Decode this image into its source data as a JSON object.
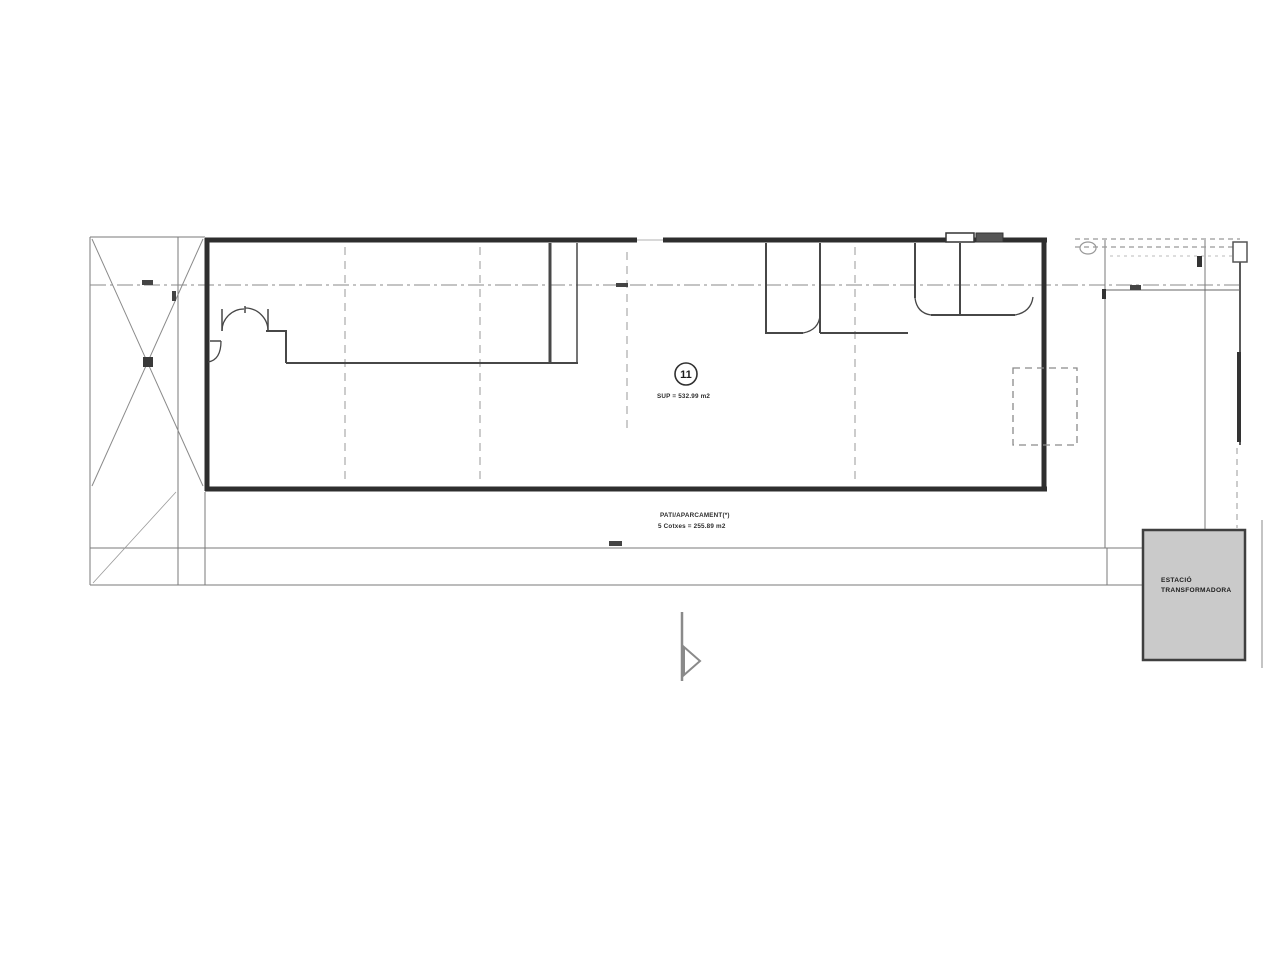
{
  "drawing": {
    "title_badge": "11",
    "area_label": "SUP = 532.99 m2",
    "parking": {
      "line1": "PATI/APARCAMENT(*)",
      "line2": "5 Cotxes = 255.89 m2"
    },
    "transformer": {
      "line1": "ESTACIÓ",
      "line2": "TRANSFORMADORA"
    }
  },
  "colors": {
    "background": "#ffffff",
    "wall": "#2e2e2e",
    "partition": "#474747",
    "site_line": "#7a7a7a",
    "dashed_line": "#999999",
    "transformer_fill": "#cacaca",
    "ink": "#1d1d1d"
  }
}
